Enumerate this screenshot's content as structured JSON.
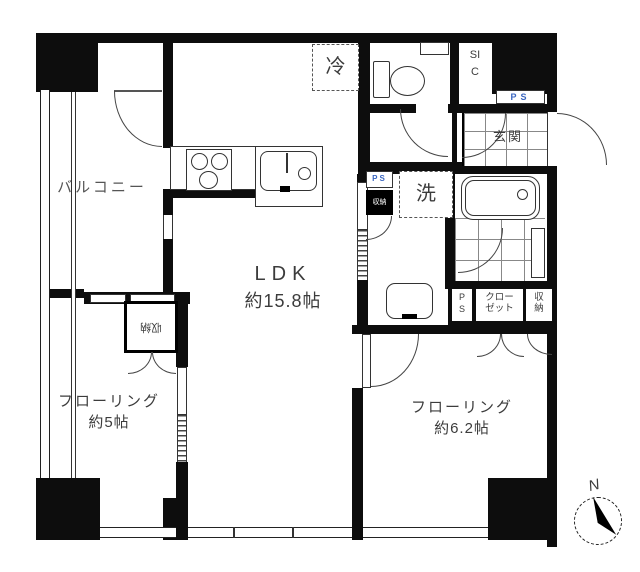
{
  "rooms": {
    "balcony": {
      "label": "バルコニー"
    },
    "ldk": {
      "label": "LDK",
      "size": "約15.8帖"
    },
    "west_room": {
      "label": "フローリング",
      "size": "約5帖"
    },
    "east_room": {
      "label": "フローリング",
      "size": "約6.2帖"
    },
    "entrance": {
      "label": "玄関"
    },
    "sic": {
      "label": "SIC"
    }
  },
  "fixtures": {
    "refrigerator": {
      "label": "冷"
    },
    "washing_machine": {
      "label": "洗"
    }
  },
  "storage": {
    "west_room_closet": {
      "label": "収納"
    },
    "east_room_closet": {
      "label": "クローゼット"
    },
    "east_room_storage": {
      "label": "収納"
    },
    "washroom_storage": {
      "label": "収納"
    },
    "closet_ps": {
      "label": "PS"
    }
  },
  "pipe_spaces": {
    "entrance_ps": {
      "label": "PS"
    },
    "washroom_ps": {
      "label": "PS"
    }
  },
  "compass": {
    "label": "N"
  },
  "colors": {
    "wall": "#0d0d0d",
    "line": "#333333",
    "ps_text": "#3a66c0",
    "background": "#ffffff"
  }
}
